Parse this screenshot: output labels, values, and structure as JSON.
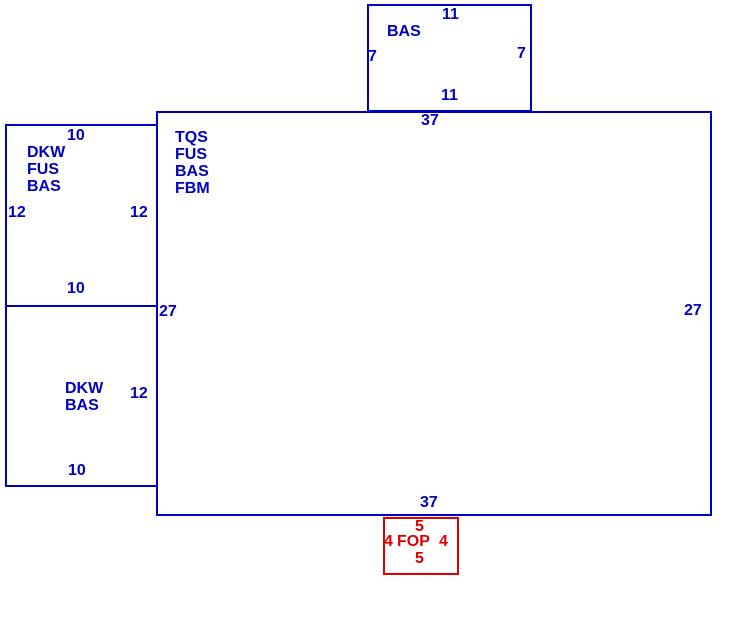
{
  "sketch": {
    "colors": {
      "outline_blue": "#0000c0",
      "outline_red": "#dd0000",
      "background": "#ffffff"
    },
    "areas": {
      "addition_top": {
        "label": "BAS",
        "dim_top": "11",
        "dim_left": "7",
        "dim_right": "7",
        "dim_bottom": "11"
      },
      "main": {
        "labels": [
          "TQS",
          "FUS",
          "BAS",
          "FBM"
        ],
        "dim_top": "37",
        "dim_left": "27",
        "dim_right": "27",
        "dim_bottom": "37"
      },
      "left_upper": {
        "labels": [
          "DKW",
          "FUS",
          "BAS"
        ],
        "dim_top": "10",
        "dim_left": "12",
        "dim_right": "12",
        "dim_bottom": "10"
      },
      "left_lower": {
        "labels": [
          "DKW",
          "BAS"
        ],
        "dim_right": "12",
        "dim_bottom": "10"
      },
      "porch": {
        "label": "FOP",
        "dim_top": "5",
        "dim_left": "4",
        "dim_right": "4",
        "dim_bottom": "5"
      }
    }
  }
}
